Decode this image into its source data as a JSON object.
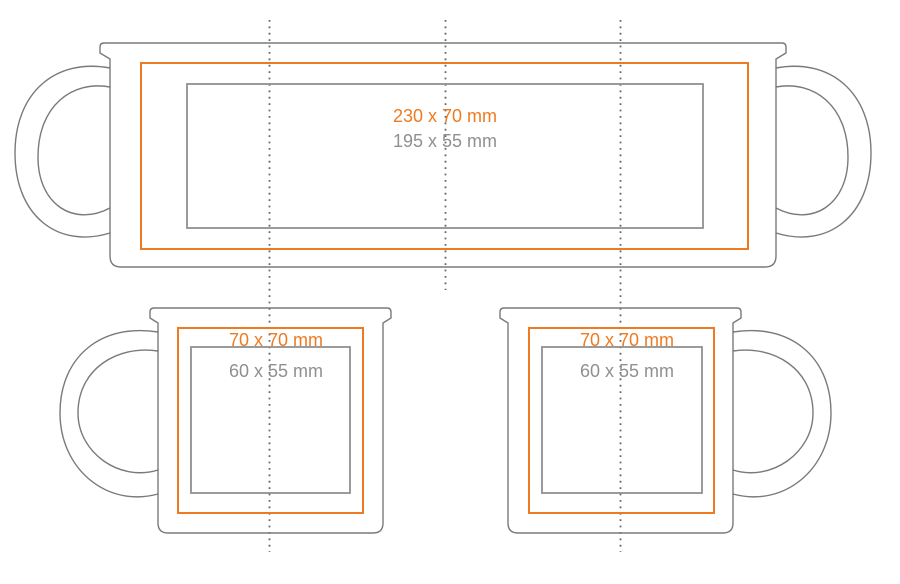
{
  "diagram_title": "mug-print-area-template",
  "colors": {
    "print_area": "#ee7b22",
    "safe_area": "#909090",
    "outline": "#7a7a7a",
    "fold_line": "#666666",
    "background": "#ffffff"
  },
  "views": [
    {
      "id": "wrap-view",
      "description": "unwrapped mug surface, handles both sides",
      "print_area_label": "230 x 70 mm",
      "safe_area_label": "195 x 55 mm"
    },
    {
      "id": "left-handle-view",
      "description": "mug side view, handle on left",
      "print_area_label": "70 x 70 mm",
      "safe_area_label": "60 x 55 mm"
    },
    {
      "id": "right-handle-view",
      "description": "mug side view, handle on right",
      "print_area_label": "70 x 70 mm",
      "safe_area_label": "60 x 55 mm"
    }
  ]
}
